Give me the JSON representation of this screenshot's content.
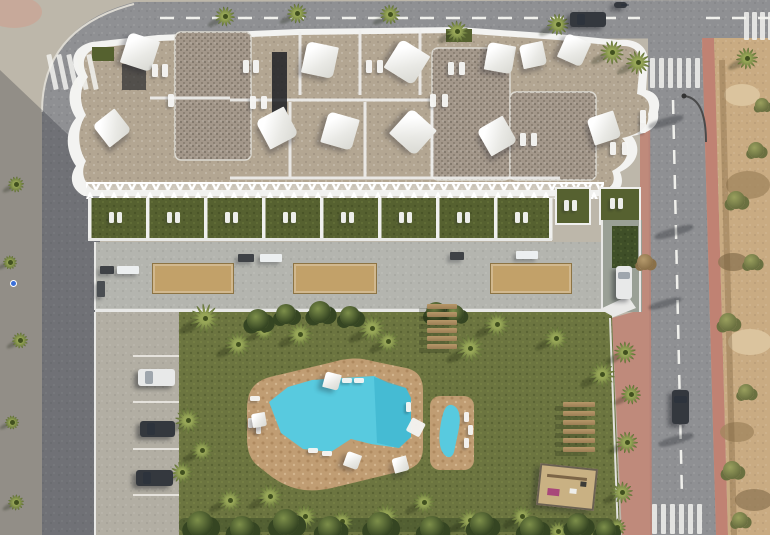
{
  "meta": {
    "title": "Aerial top-down 3D render of a residential apartment complex",
    "elements": [
      "building with rooftop terraces and shade sails",
      "private lawn terraces row",
      "pedestrian walkway with planters",
      "communal garden",
      "free-form swimming pool",
      "children's pool",
      "playground",
      "outdoor bench rows",
      "parking bays with cars",
      "perimeter roads with crosswalks",
      "undeveloped rocky plot"
    ]
  },
  "palette": {
    "base": "#bdb7aa",
    "road": "#8f9093",
    "sidewalkPink": "#c08273",
    "pinkLight": "#cf9f8d",
    "dirt": "#c9ab82",
    "dirtDark": "#a2875f",
    "dirtLight": "#dbc49e",
    "roofGravel": "#b3a692",
    "roofDark": "#a3978a",
    "parapet": "#f3f3f1",
    "terraceGreen": "#566130",
    "pergola": "#e9e9e7",
    "walkway": "#b4b5af",
    "parkingSlab": "#b2aea3",
    "planterSand": "#c2a169",
    "lawn": "#6c7540",
    "lawnDark": "#55612f",
    "hedge": "#3f4f28",
    "palmLeaf": "#97a657",
    "palmDark": "#5c6c34",
    "deck": "#c09d73",
    "water": "#58cadf",
    "waterDeep": "#2fa9c6",
    "furnitureWhite": "#f6f6f4",
    "carDark": "#34383e",
    "carWhite": "#e8e9e9",
    "wood": "#b79869",
    "sand": "#c9b183",
    "laneGray": "#9aa096"
  },
  "scene": {
    "sails": [
      [
        140,
        52,
        32,
        18
      ],
      [
        112,
        128,
        28,
        -38
      ],
      [
        320,
        60,
        32,
        12
      ],
      [
        407,
        62,
        34,
        32
      ],
      [
        277,
        128,
        32,
        -28
      ],
      [
        340,
        131,
        32,
        16
      ],
      [
        413,
        132,
        34,
        42
      ],
      [
        500,
        58,
        28,
        10
      ],
      [
        533,
        55,
        24,
        -12
      ],
      [
        574,
        50,
        26,
        24
      ],
      [
        497,
        136,
        30,
        -30
      ],
      [
        604,
        128,
        28,
        -18
      ]
    ],
    "roofLoungers": [
      [
        152,
        64
      ],
      [
        162,
        64
      ],
      [
        243,
        60
      ],
      [
        253,
        60
      ],
      [
        366,
        60
      ],
      [
        377,
        60
      ],
      [
        448,
        62
      ],
      [
        459,
        62
      ],
      [
        250,
        96
      ],
      [
        261,
        96
      ],
      [
        168,
        94
      ],
      [
        430,
        94
      ],
      [
        442,
        94
      ],
      [
        520,
        133
      ],
      [
        531,
        133
      ],
      [
        610,
        142
      ],
      [
        622,
        142
      ],
      [
        640,
        110
      ],
      [
        640,
        120
      ]
    ],
    "terraceRow": {
      "x": 88,
      "y": 198,
      "w": 464,
      "h": 42,
      "cells": 8,
      "cellW": 58
    },
    "rightTerraces": [
      [
        556,
        188,
        34,
        36
      ],
      [
        600,
        188,
        40,
        36
      ]
    ],
    "rightTerraceLoungers": [
      [
        564,
        200
      ],
      [
        572,
        200
      ],
      [
        610,
        198
      ],
      [
        618,
        198
      ]
    ],
    "planters": [
      [
        152,
        263,
        80,
        29
      ],
      [
        293,
        263,
        82,
        29
      ],
      [
        490,
        263,
        80,
        29
      ]
    ],
    "walkwayBenches": [
      [
        100,
        266,
        14,
        8,
        "#3f4246"
      ],
      [
        117,
        266,
        22,
        8,
        "#eceff0"
      ],
      [
        238,
        254,
        16,
        8,
        "#3f4246"
      ],
      [
        260,
        254,
        22,
        8,
        "#eceff0"
      ],
      [
        450,
        252,
        14,
        8,
        "#3f4246"
      ],
      [
        516,
        251,
        22,
        8,
        "#eceff0"
      ],
      [
        97,
        281,
        8,
        16,
        "#4a4e52"
      ]
    ],
    "gardenPalms": [
      [
        205,
        318,
        15
      ],
      [
        238,
        344,
        13
      ],
      [
        264,
        330,
        10
      ],
      [
        300,
        334,
        13
      ],
      [
        372,
        328,
        14
      ],
      [
        388,
        341,
        11
      ],
      [
        470,
        348,
        14
      ],
      [
        497,
        324,
        13
      ],
      [
        556,
        338,
        12
      ],
      [
        602,
        374,
        13
      ],
      [
        188,
        420,
        13
      ],
      [
        202,
        450,
        11
      ],
      [
        182,
        472,
        11
      ],
      [
        230,
        500,
        12
      ],
      [
        270,
        496,
        13
      ],
      [
        305,
        516,
        12
      ],
      [
        342,
        521,
        11
      ],
      [
        386,
        516,
        13
      ],
      [
        424,
        502,
        11
      ],
      [
        470,
        520,
        12
      ],
      [
        522,
        516,
        11
      ],
      [
        558,
        531,
        10
      ],
      [
        625,
        352,
        11
      ],
      [
        631,
        394,
        10
      ],
      [
        627,
        442,
        11
      ],
      [
        622,
        492,
        11
      ],
      [
        617,
        527,
        9
      ]
    ],
    "streetPalms": [
      [
        225,
        16,
        10
      ],
      [
        297,
        13,
        10
      ],
      [
        390,
        14,
        10
      ],
      [
        457,
        31,
        11
      ],
      [
        558,
        24,
        11
      ],
      [
        612,
        52,
        12
      ],
      [
        638,
        62,
        12
      ],
      [
        747,
        58,
        11
      ],
      [
        16,
        184,
        8
      ],
      [
        10,
        262,
        7
      ],
      [
        20,
        340,
        8
      ],
      [
        12,
        422,
        7
      ],
      [
        16,
        502,
        8
      ]
    ],
    "dirtShrubs": [
      [
        736,
        200,
        9
      ],
      [
        752,
        262,
        8
      ],
      [
        728,
        322,
        9
      ],
      [
        746,
        392,
        8
      ],
      [
        732,
        470,
        9
      ],
      [
        756,
        150,
        8
      ],
      [
        762,
        105,
        7
      ],
      [
        740,
        520,
        8
      ]
    ],
    "deadShrubs": [
      [
        645,
        262,
        8
      ]
    ],
    "hedgeShrubs": [
      [
        200,
        524,
        13
      ],
      [
        242,
        528,
        12
      ],
      [
        286,
        522,
        13
      ],
      [
        330,
        528,
        12
      ],
      [
        380,
        525,
        13
      ],
      [
        432,
        528,
        12
      ],
      [
        482,
        524,
        12
      ],
      [
        532,
        528,
        12
      ],
      [
        578,
        524,
        11
      ],
      [
        606,
        530,
        10
      ],
      [
        258,
        320,
        11
      ],
      [
        286,
        314,
        10
      ],
      [
        320,
        312,
        11
      ],
      [
        350,
        316,
        10
      ],
      [
        436,
        312,
        10
      ],
      [
        455,
        314,
        9
      ]
    ],
    "poolLoungers": [
      [
        342,
        378,
        10,
        5
      ],
      [
        354,
        378,
        10,
        5
      ],
      [
        250,
        396,
        10,
        5
      ],
      [
        248,
        418,
        5,
        10
      ],
      [
        256,
        424,
        5,
        10
      ],
      [
        308,
        448,
        10,
        5
      ],
      [
        322,
        451,
        10,
        5
      ],
      [
        406,
        402,
        5,
        10
      ],
      [
        464,
        412,
        5,
        10
      ],
      [
        468,
        425,
        5,
        10
      ],
      [
        464,
        438,
        5,
        10
      ]
    ],
    "parasols": [
      [
        332,
        381,
        16,
        15
      ],
      [
        259,
        420,
        14,
        -10
      ],
      [
        352,
        460,
        15,
        20
      ],
      [
        400,
        464,
        15,
        -15
      ]
    ],
    "steps": {
      "x": 427,
      "y": 304,
      "w": 30,
      "h": 5,
      "gap": 8,
      "count": 6
    },
    "benchRows": {
      "x": 563,
      "y": 402,
      "w": 32,
      "h": 5,
      "gap": 9,
      "count": 6
    },
    "playground": {
      "x": 538,
      "y": 466,
      "w": 54,
      "h": 38,
      "rot": 6
    },
    "cars": [
      {
        "x": 570,
        "y": 12,
        "w": 36,
        "h": 15,
        "tone": "dark",
        "vert": false
      },
      {
        "x": 614,
        "y": 2,
        "w": 13,
        "h": 6,
        "tone": "dark",
        "vert": false
      },
      {
        "x": 672,
        "y": 390,
        "w": 17,
        "h": 34,
        "tone": "dark",
        "vert": true
      },
      {
        "x": 616,
        "y": 266,
        "w": 16,
        "h": 33,
        "tone": "white",
        "vert": true
      },
      {
        "x": 138,
        "y": 369,
        "w": 37,
        "h": 17,
        "tone": "white",
        "vert": false
      },
      {
        "x": 140,
        "y": 421,
        "w": 35,
        "h": 16,
        "tone": "dark",
        "vert": false
      },
      {
        "x": 136,
        "y": 470,
        "w": 37,
        "h": 16,
        "tone": "dark",
        "vert": false
      }
    ],
    "crosswalks": [
      {
        "x": 50,
        "y": 54,
        "count": 5,
        "dx": 10,
        "barW": 5,
        "barH": 36,
        "rot": -12
      },
      {
        "x": 650,
        "y": 58,
        "count": 6,
        "dx": 9,
        "barW": 5,
        "barH": 30,
        "rot": 0
      },
      {
        "x": 652,
        "y": 504,
        "count": 6,
        "dx": 9,
        "barW": 5,
        "barH": 30,
        "rot": 0
      },
      {
        "x": 744,
        "y": 12,
        "count": 4,
        "dx": 8,
        "barW": 5,
        "barH": 28,
        "rot": 0
      }
    ],
    "roadShadows": [
      [
        648,
        118,
        36,
        8
      ],
      [
        654,
        228,
        40,
        8
      ],
      [
        648,
        300,
        34,
        7
      ],
      [
        658,
        436,
        36,
        8
      ]
    ],
    "signs": [
      {
        "x": 11,
        "y": 281,
        "color": "#3a6fd8"
      }
    ]
  }
}
